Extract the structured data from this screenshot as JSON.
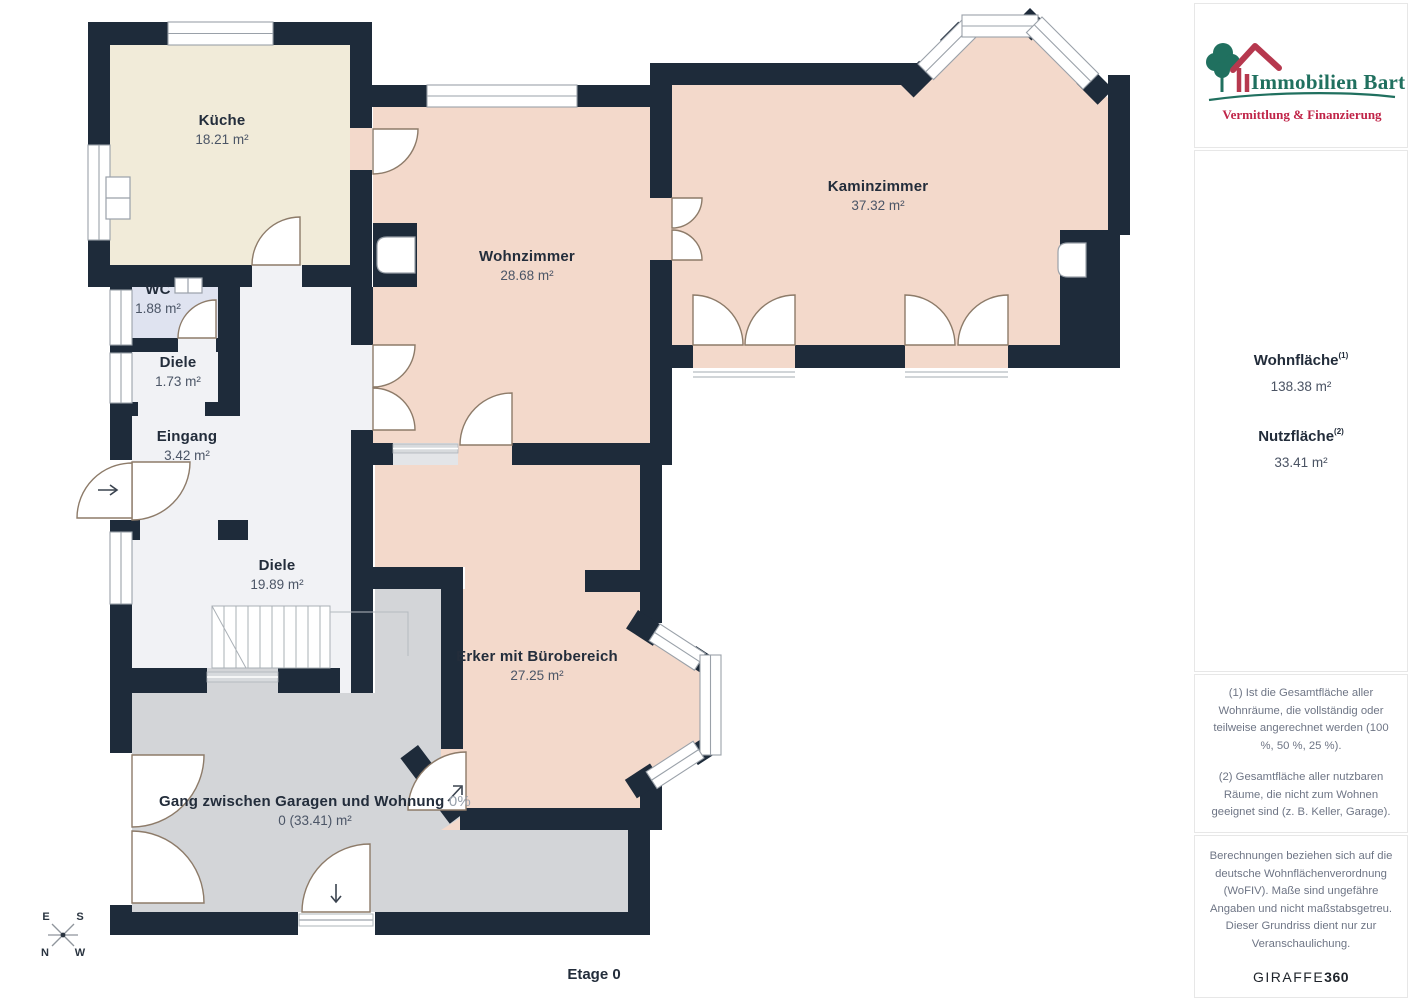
{
  "floorplan": {
    "floor_label": "Etage 0",
    "rooms": [
      {
        "name": "Küche",
        "area": "18.21 m²"
      },
      {
        "name": "WC",
        "area": "1.88 m²"
      },
      {
        "name": "Diele",
        "area": "1.73 m²"
      },
      {
        "name": "Eingang",
        "area": "3.42 m²"
      },
      {
        "name": "Diele",
        "area": "19.89 m²"
      },
      {
        "name": "Wohnzimmer",
        "area": "28.68 m²"
      },
      {
        "name": "Kaminzimmer",
        "area": "37.32 m²"
      },
      {
        "name": "Erker mit Bürobereich",
        "area": "27.25 m²"
      },
      {
        "name": "Gang zwischen Garagen und Wohnung",
        "pct": "0%",
        "area": "0 (33.41) m²"
      }
    ],
    "compass": {
      "e": "E",
      "s": "S",
      "n": "N",
      "w": "W"
    }
  },
  "sidebar": {
    "logo": {
      "title": "Immobilien Bart",
      "subtitle": "Vermittlung & Finanzierung"
    },
    "stats": [
      {
        "label": "Wohnfläche",
        "sup": "(1)",
        "value": "138.38 m²"
      },
      {
        "label": "Nutzfläche",
        "sup": "(2)",
        "value": "33.41 m²"
      }
    ],
    "footnotes": [
      "(1) Ist die Gesamtfläche aller Wohnräume, die vollständig oder teilweise angerechnet werden (100 %, 50 %, 25 %).",
      "(2) Gesamtfläche aller nutzbaren Räume, die nicht zum Wohnen geeignet sind (z. B. Keller, Garage)."
    ],
    "disclaimer": "Berechnungen beziehen sich auf die deutsche Wohnflächenverordnung (WoFIV). Maße sind ungefähre Angaben und nicht maßstabsgetreu. Dieser Grundriss dient nur zur Veranschaulichung.",
    "brand": {
      "name": "GIRAFFE",
      "bold": "360"
    }
  },
  "colors": {
    "wall": "#1e2b3a",
    "living_rooms": "#f3d9cb",
    "kitchen": "#f1ebd9",
    "wc": "#dfe3f0",
    "corridor": "#f1f2f5",
    "gang": "#d3d5d8",
    "door_arc": "#8d7b69",
    "window_frame": "#9aa1a9",
    "logo_green": "#20705f",
    "logo_red": "#c02448"
  }
}
